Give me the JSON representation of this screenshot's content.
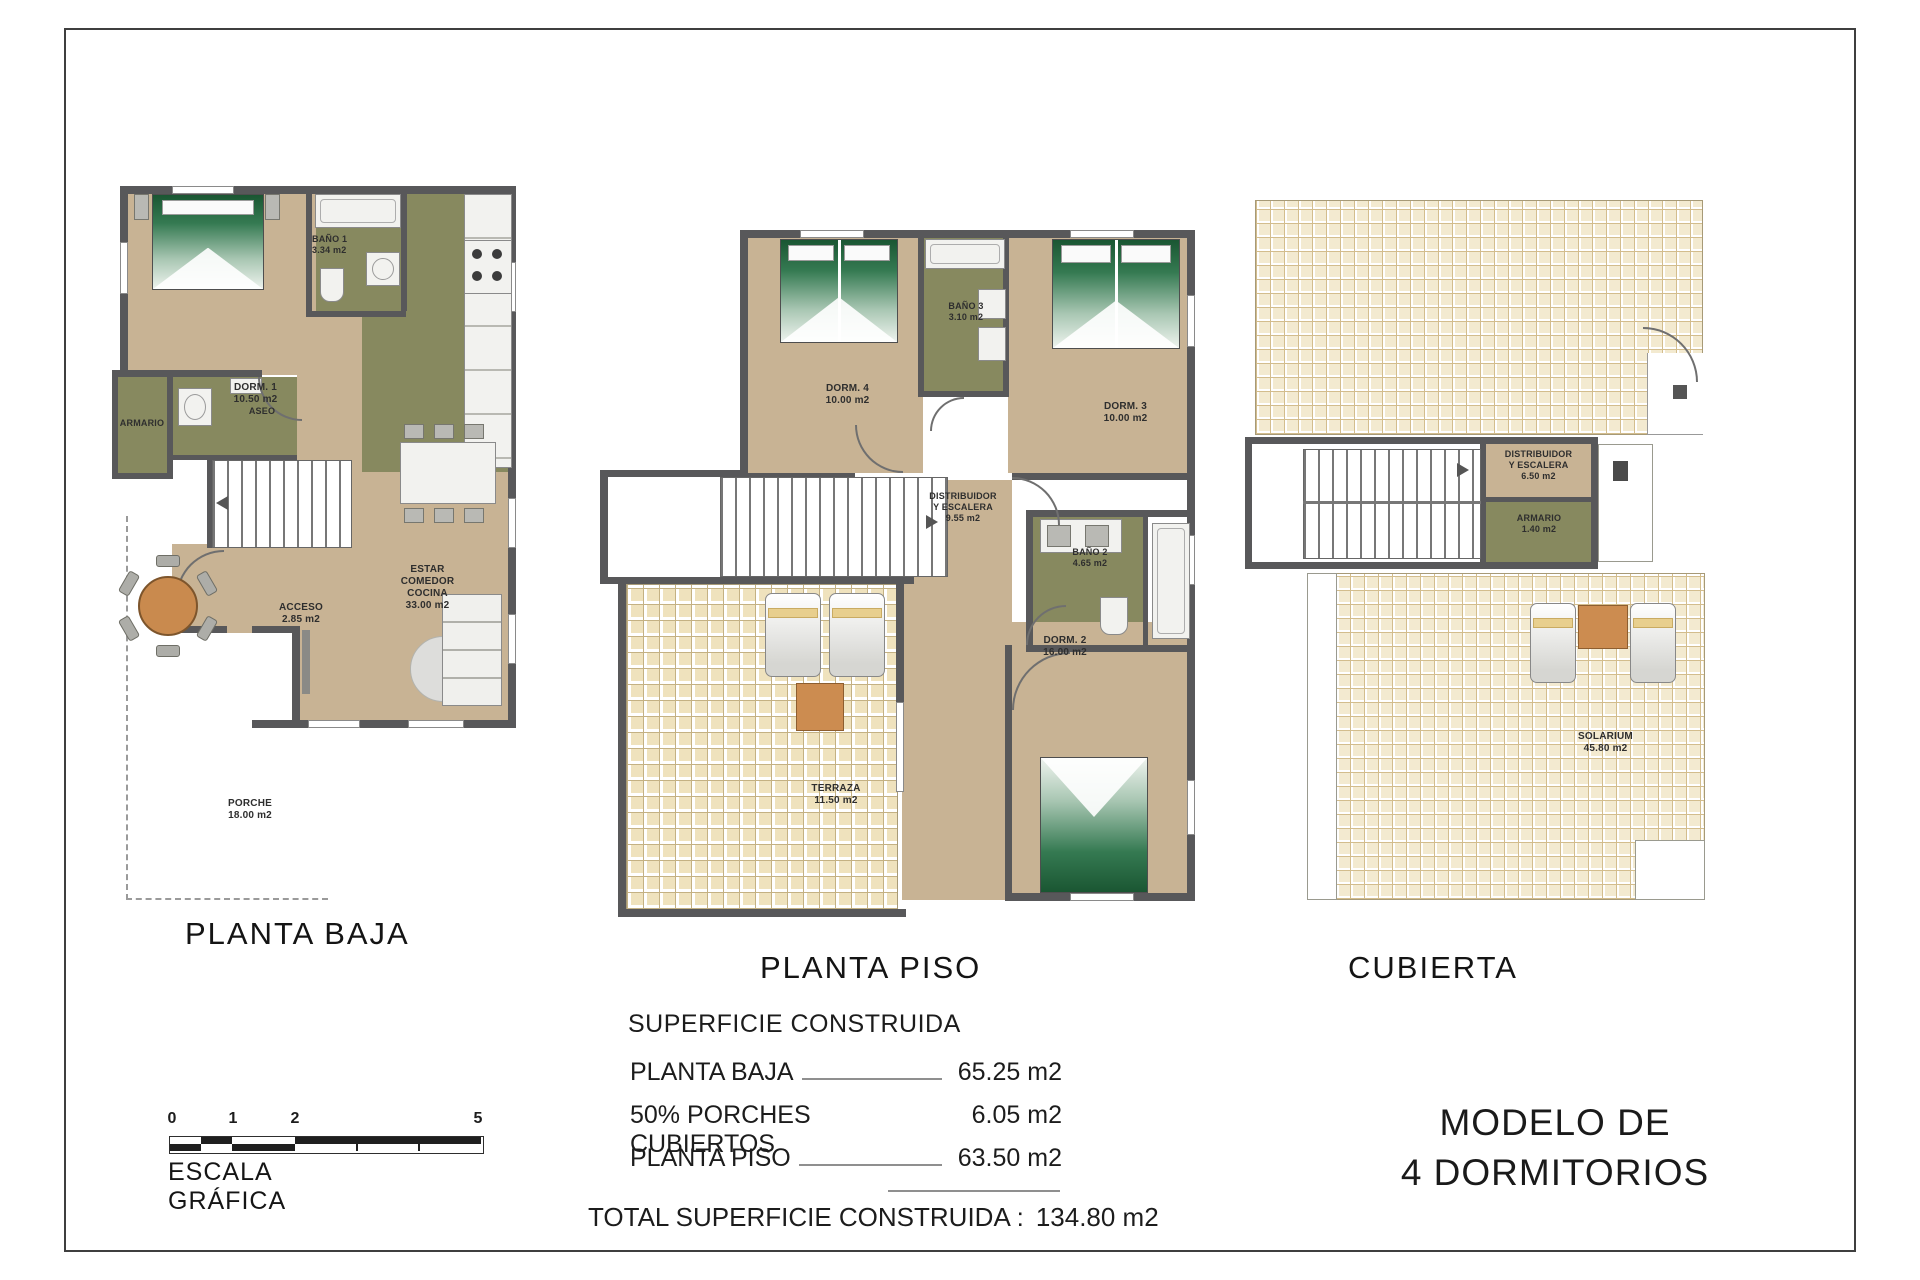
{
  "plans": [
    {
      "title": "PLANTA BAJA",
      "rooms": {
        "dorm1": "DORM. 1\n10.50 m2",
        "bano1": "BAÑO 1\n3.34 m2",
        "armario": "ARMARIO",
        "aseo": "ASEO",
        "estar": "ESTAR\nCOMEDOR\nCOCINA\n33.00 m2",
        "acceso": "ACCESO\n2.85 m2",
        "porche": "PORCHE\n18.00 m2"
      }
    },
    {
      "title": "PLANTA PISO",
      "rooms": {
        "dorm4": "DORM. 4\n10.00 m2",
        "bano3": "BAÑO 3\n3.10 m2",
        "dorm3": "DORM. 3\n10.00 m2",
        "distribuidor": "DISTRIBUIDOR\nY ESCALERA\n9.55 m2",
        "bano2": "BAÑO 2\n4.65 m2",
        "dorm2": "DORM. 2\n16.00 m2",
        "terraza": "TERRAZA\n11.50 m2"
      }
    },
    {
      "title": "CUBIERTA",
      "rooms": {
        "distribuidor": "DISTRIBUIDOR\nY ESCALERA\n6.50 m2",
        "armario": "ARMARIO\n1.40 m2",
        "solarium": "SOLARIUM\n45.80 m2"
      }
    }
  ],
  "summary": {
    "title": "SUPERFICIE CONSTRUIDA",
    "rows": [
      {
        "label": "PLANTA BAJA",
        "value": "65.25 m2"
      },
      {
        "label": "50% PORCHES CUBIERTOS",
        "value": "6.05 m2"
      },
      {
        "label": "PLANTA PISO",
        "value": "63.50 m2"
      }
    ],
    "total_label": "TOTAL SUPERFICIE CONSTRUIDA :",
    "total_value": "134.80 m2"
  },
  "scale_bar": {
    "ticks": [
      "0",
      "1",
      "2",
      "5"
    ],
    "label": "ESCALA GRÁFICA"
  },
  "model": {
    "line1": "MODELO DE",
    "line2": "4 DORMITORIOS"
  },
  "colors": {
    "wall": "#58585a",
    "floor_tan": "#c8b394",
    "room_olive": "#87895f",
    "tile_cream": "#efe2bd",
    "table_orange": "#cc8c50",
    "bed_green": "#1a5632"
  }
}
